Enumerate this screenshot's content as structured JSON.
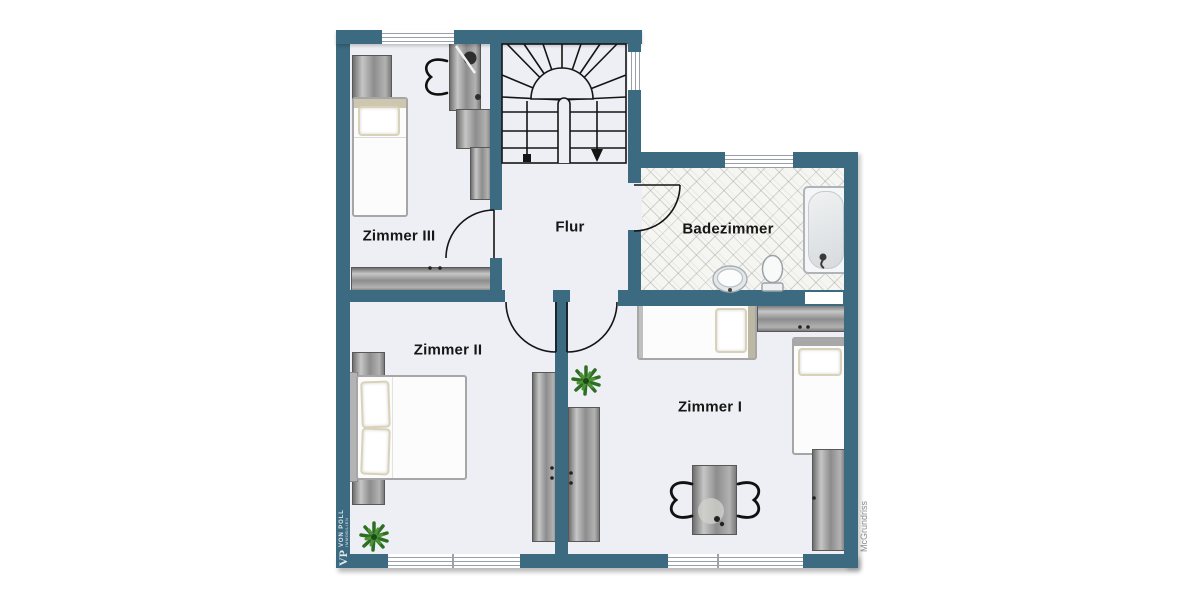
{
  "colors": {
    "wall": "#3c6a81",
    "floor": "#edeff4",
    "label": "#161616",
    "bedtrim": "#d9d2b8",
    "linework": "#151515",
    "plant": "#2e6e24",
    "watermarkright": "#8b8b8b"
  },
  "rooms": [
    {
      "id": "zimmer-3",
      "label": "Zimmer III"
    },
    {
      "id": "flur",
      "label": "Flur"
    },
    {
      "id": "badezimmer",
      "label": "Badezimmer"
    },
    {
      "id": "zimmer-2",
      "label": "Zimmer II"
    },
    {
      "id": "zimmer-1",
      "label": "Zimmer I"
    }
  ],
  "watermarks": {
    "left_monogram": "VP",
    "left_brand": "VON POLL",
    "left_sub": "IMMOBILIEN",
    "right_credit": "McGrundriss"
  },
  "furniture": {
    "zimmer_3": [
      "dresser",
      "single-bed",
      "desk",
      "desk-chair",
      "desk-lamp",
      "wardrobe",
      "cabinet",
      "sideboard"
    ],
    "flur": [
      "staircase"
    ],
    "badezimmer": [
      "bathtub",
      "toilet",
      "sink"
    ],
    "zimmer_2": [
      "double-bed",
      "nightstand",
      "nightstand",
      "wardrobe",
      "plant"
    ],
    "zimmer_1": [
      "single-bed",
      "single-bed",
      "shelf",
      "wardrobe",
      "desk",
      "desk-chair",
      "desk-chair",
      "plant"
    ]
  }
}
